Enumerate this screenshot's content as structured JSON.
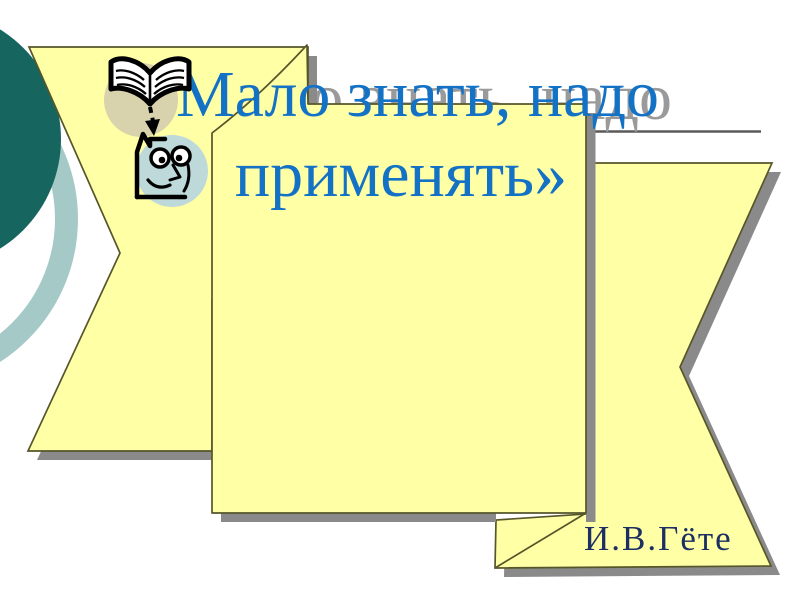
{
  "slide": {
    "title": {
      "line1": "«Мало знать, надо",
      "line2": "применять»",
      "full_text": "«Мало знать, надо применять»",
      "color": "#1372c5",
      "shadow_text_color": "#9a9a9a"
    },
    "attribution": {
      "text": "И.В.Гёте",
      "color": "#1c2f63"
    },
    "decorations": {
      "paper_fill": "#ffffa6",
      "paper_outline": "#56562a",
      "paper_shadow": "#8a8a8a",
      "dark_circle_color": "#17655f",
      "ring_color": "#a5c9c7",
      "underline_color": "#5a5a5a"
    },
    "icons": [
      {
        "name": "open-book-icon"
      },
      {
        "name": "down-arrow-icon"
      },
      {
        "name": "reader-face-icon"
      }
    ]
  }
}
